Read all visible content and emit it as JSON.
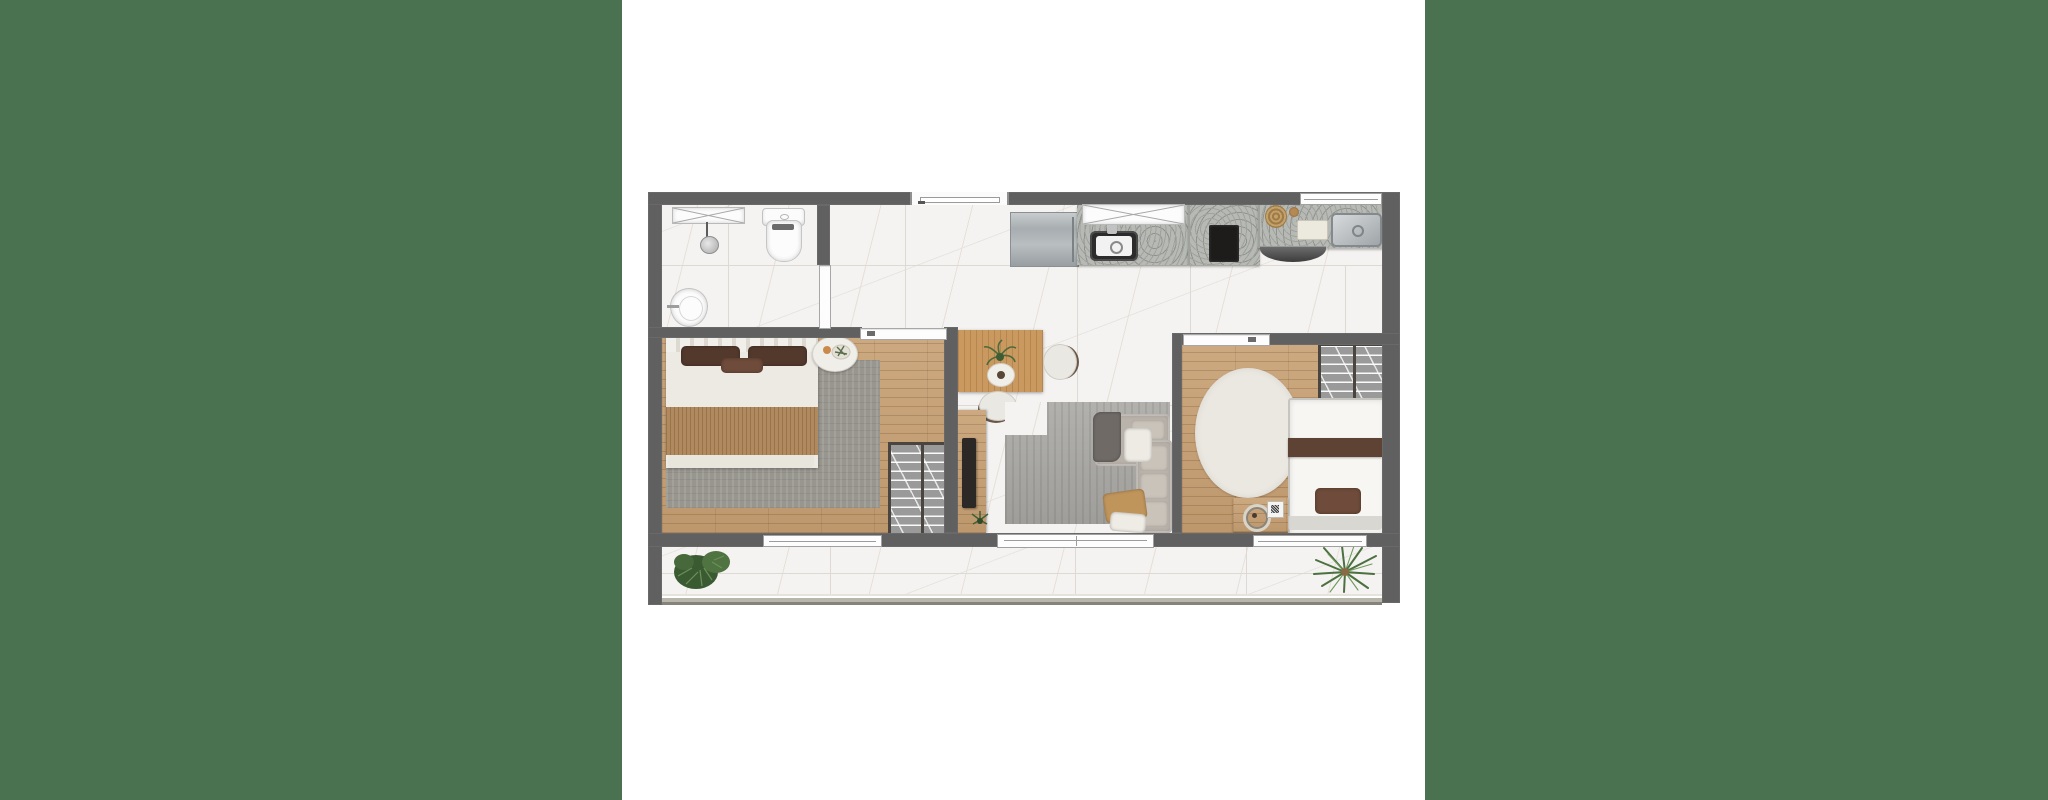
{
  "image_kind": "apartment-floor-plan-render",
  "colors": {
    "green": "#4a7150",
    "wall": "#606060",
    "marble": "#f4f3f1",
    "tileLine": "#ddd9d3",
    "vein": "#d9cec0",
    "wood": "#c7a176",
    "granite": "#b7bab4",
    "graniteDot": "#9a9d98",
    "rug1": "#98968f",
    "rugL": "#a7a6a2",
    "sofa": "#b9b3ab",
    "sofaCushion": "#c9c3ba",
    "oval": "#ebe8e1",
    "blanket": "#b08a5e",
    "tableWood": "#c99960",
    "closet": "#9a9a9a",
    "closetFrame": "#4b4540",
    "cooktop": "#1d1c1b",
    "railing": "#b9b6ac",
    "plant": "#4f7341",
    "plantDark": "#3a5a32",
    "pillowDark": "#52392c",
    "pillowBrown": "#6e4b3a",
    "bedBand": "#5e4335",
    "duvet": "#edeae4"
  },
  "regions": [
    {
      "name": "bathroom"
    },
    {
      "name": "entry-hall"
    },
    {
      "name": "kitchen"
    },
    {
      "name": "service-area"
    },
    {
      "name": "living-dining"
    },
    {
      "name": "bedroom-1"
    },
    {
      "name": "bedroom-2"
    },
    {
      "name": "balcony"
    }
  ],
  "fixtures": [
    "shower-box",
    "shower-head",
    "toilet",
    "washbasin",
    "entry-door",
    "fridge",
    "kitchen-sink",
    "cooktop",
    "service-sink",
    "dish-rack",
    "dining-table",
    "dining-chairs",
    "tv-console",
    "tv",
    "sofa",
    "living-rug",
    "double-bed",
    "bedside-table",
    "wardrobe-1",
    "wardrobe-2",
    "single-bed",
    "oval-rug",
    "desk",
    "balcony-plants",
    "balcony-railing",
    "sliding-doors",
    "windows"
  ]
}
